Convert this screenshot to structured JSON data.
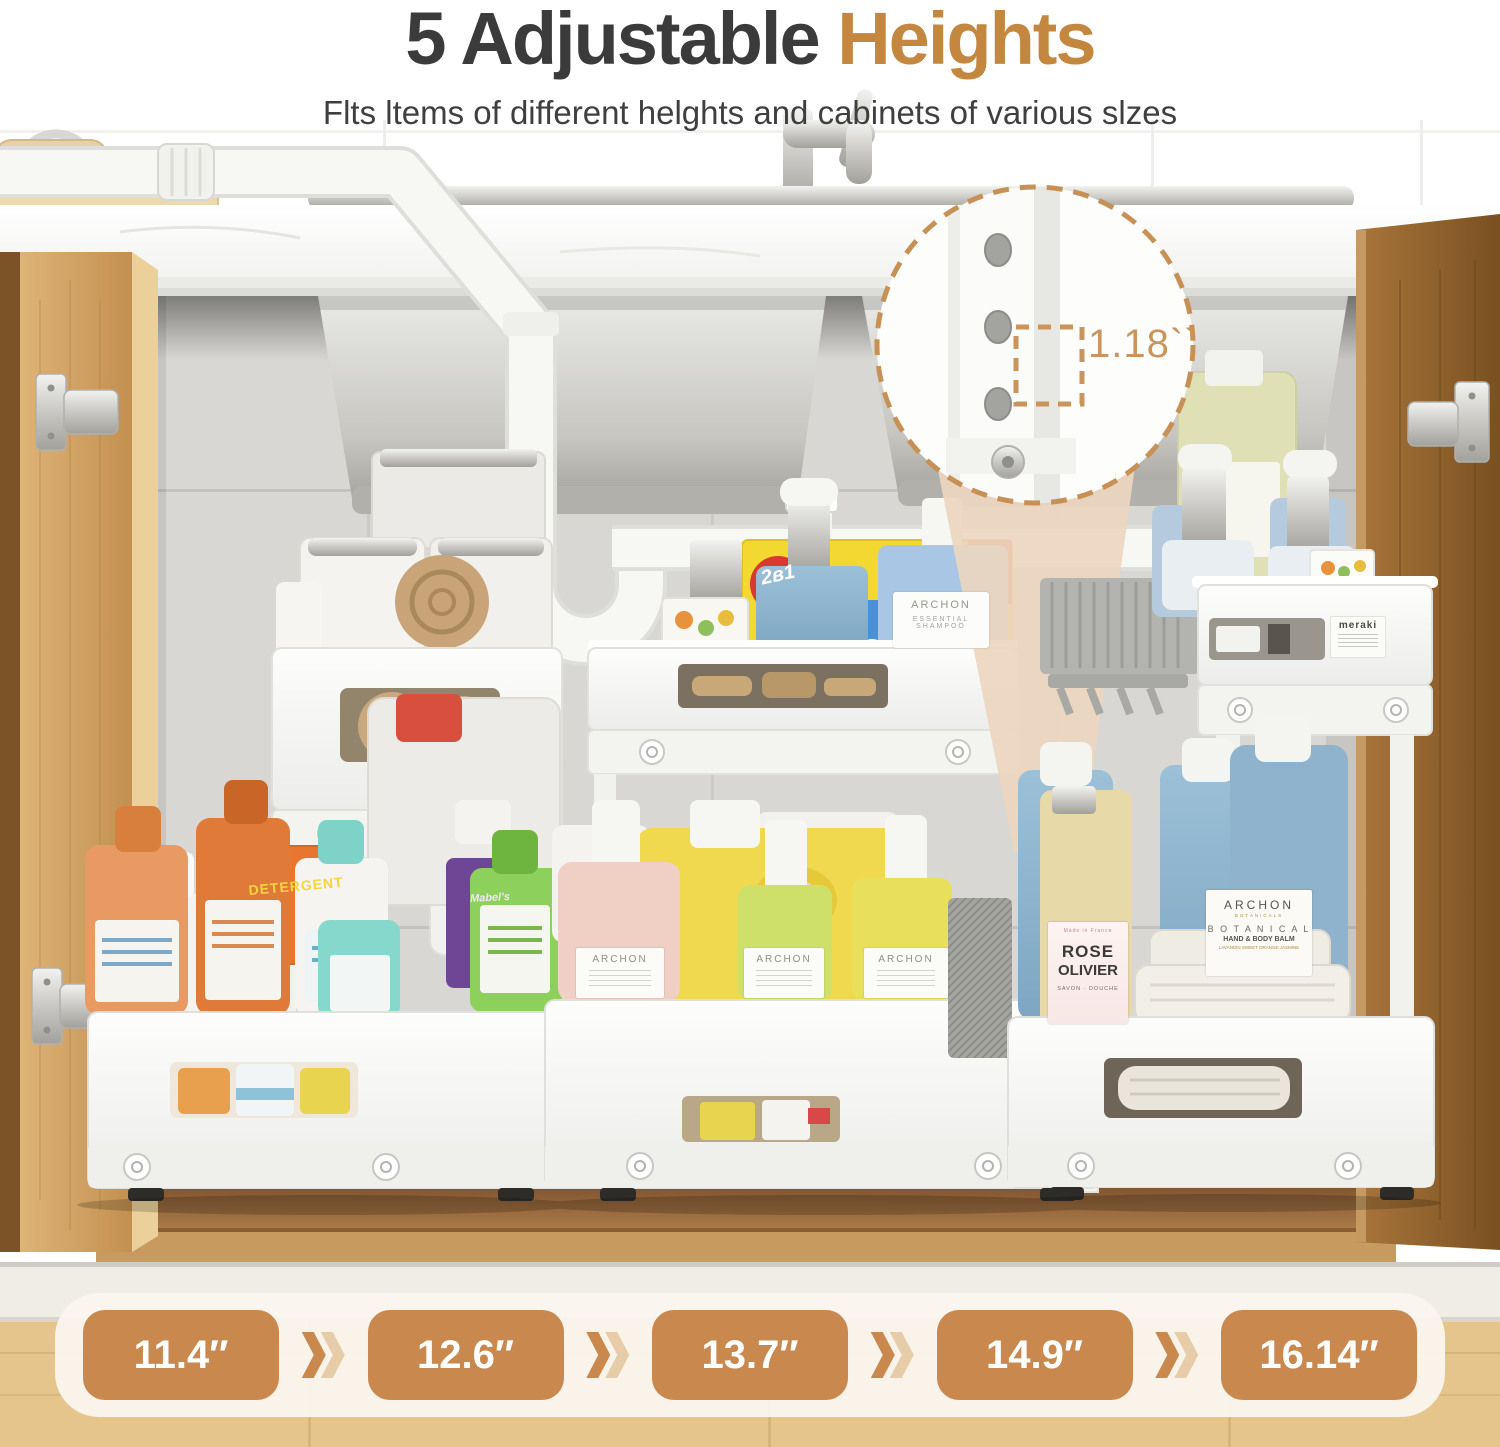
{
  "header": {
    "title_dark": "5 Adjustable",
    "title_accent": "Heights",
    "subtitle": "Flts ltems of different helghts and cabinets of various slzes"
  },
  "callout": {
    "measurement": "1.18``"
  },
  "heights_bar": {
    "values": [
      "11.4″",
      "12.6″",
      "13.7″",
      "14.9″",
      "16.14″"
    ]
  },
  "products": {
    "box_label": "2в1",
    "shampoo": {
      "brand": "ARCHON",
      "line1": "ESSENTIAL",
      "line2": "SHAMPOO"
    },
    "balm": {
      "brand": "ARCHON",
      "sub": "BOTANICALS",
      "line1": "B O T A N I C A L",
      "line2": "HAND & BODY BALM",
      "line3": "LAVANDIN SWEET ORANGE JASMINE"
    },
    "rose": {
      "origin": "Made in France",
      "line1": "ROSE",
      "line2": "OLIVIER",
      "line3": "SAVON · DOUCHE"
    },
    "pump_label": "ARCHON",
    "detergent_label": "DETERGENT",
    "mabels_label": "Mabel's",
    "meraki_label": "meraki"
  },
  "colors": {
    "accent": "#c4873f",
    "title": "#3b3b3b",
    "badge": "#c9884e",
    "badge_text": "#ffffff",
    "bar_bg": "#f8f2e9",
    "callout": "#c9955c",
    "wood_light": "#d9ac6f",
    "wood_dark": "#8a5c2e",
    "tile_gray": "#d8d7d4"
  }
}
